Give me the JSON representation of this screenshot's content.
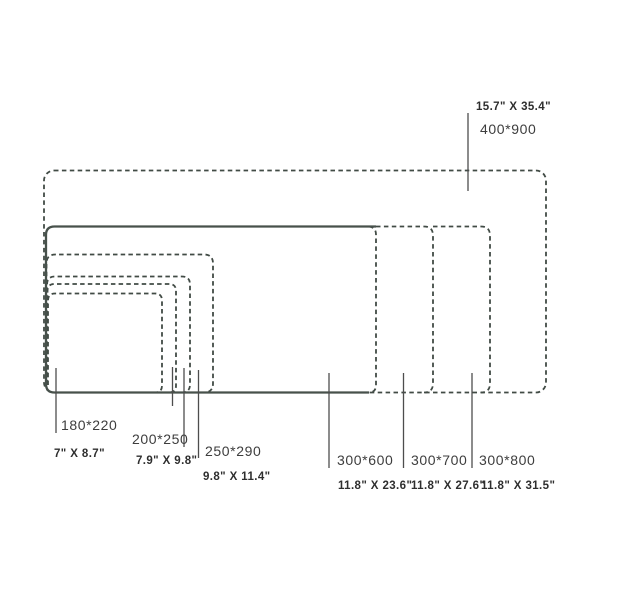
{
  "diagram": {
    "type": "nested-size-chart",
    "background": "#ffffff",
    "line_color": "#414b45",
    "solid_line_color": "#47514b",
    "leader_line_color": "#4d4d4d",
    "mm_label_color": "#3d3d3d",
    "inch_label_color": "#2e2e2e",
    "sizes": [
      {
        "id": "180x220",
        "mm": "180*220",
        "inches": "7\" X 8.7\"",
        "outline": "dashed"
      },
      {
        "id": "200x250",
        "mm": "200*250",
        "inches": "7.9\" X 9.8\"",
        "outline": "dashed"
      },
      {
        "id": "250x290",
        "mm": "250*290",
        "inches": "9.8\" X 11.4\"",
        "outline": "dashed"
      },
      {
        "id": "300x600",
        "mm": "300*600",
        "inches": "11.8\" X 23.6\"",
        "outline": "solid"
      },
      {
        "id": "300x700",
        "mm": "300*700",
        "inches": "11.8\" X 27.6\"",
        "outline": "dashed"
      },
      {
        "id": "300x800",
        "mm": "300*800",
        "inches": "11.8\" X 31.5\"",
        "outline": "dashed"
      },
      {
        "id": "400x900",
        "mm": "400*900",
        "inches": "15.7\" X 35.4\"",
        "outline": "dashed"
      }
    ]
  }
}
